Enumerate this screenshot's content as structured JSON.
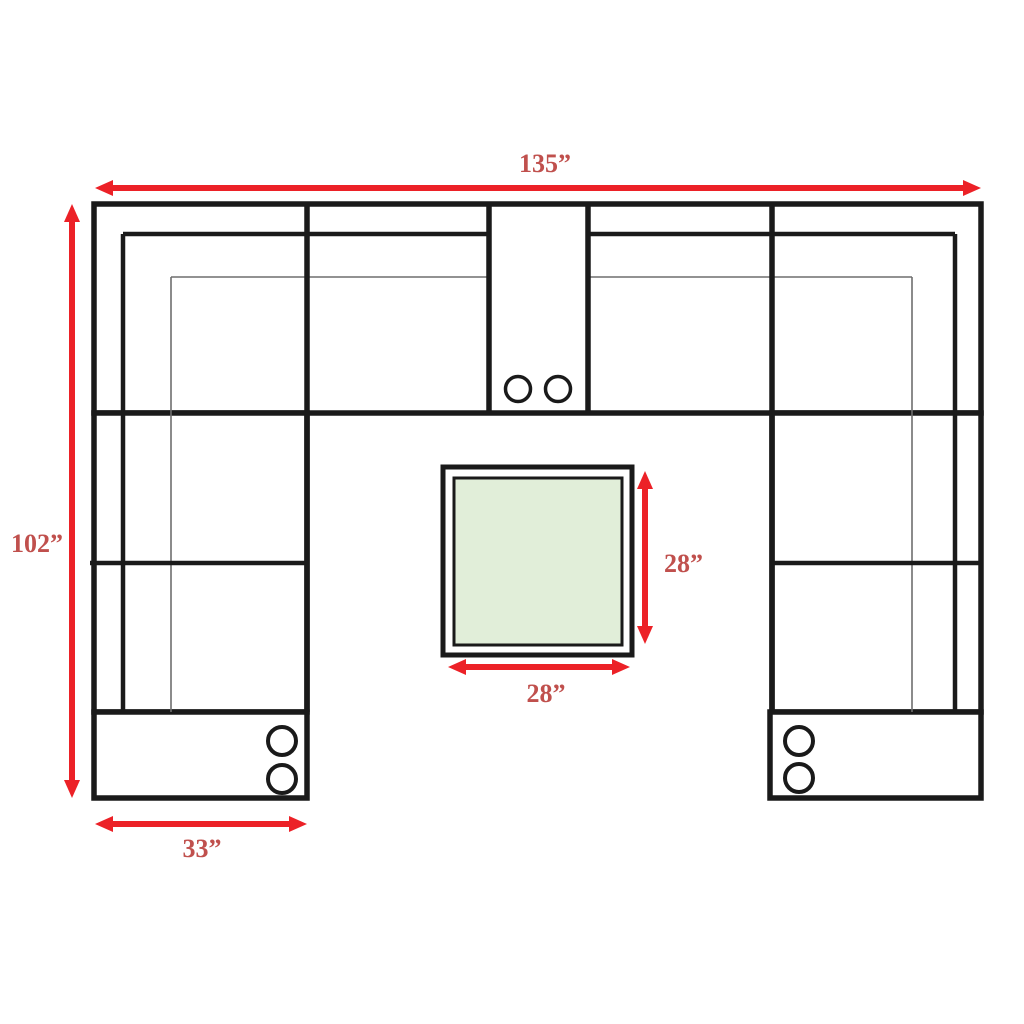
{
  "labels": {
    "overall_width": "135”",
    "overall_depth": "102”",
    "chaise_width": "33”",
    "table_depth": "28”",
    "table_width": "28”"
  },
  "colors": {
    "background": "#ffffff",
    "line": "#1a1a1a",
    "thin_line": "#6e6e6e",
    "arrow": "#ec2127",
    "label": "#c0504d",
    "table_fill": "#e1eed9"
  }
}
